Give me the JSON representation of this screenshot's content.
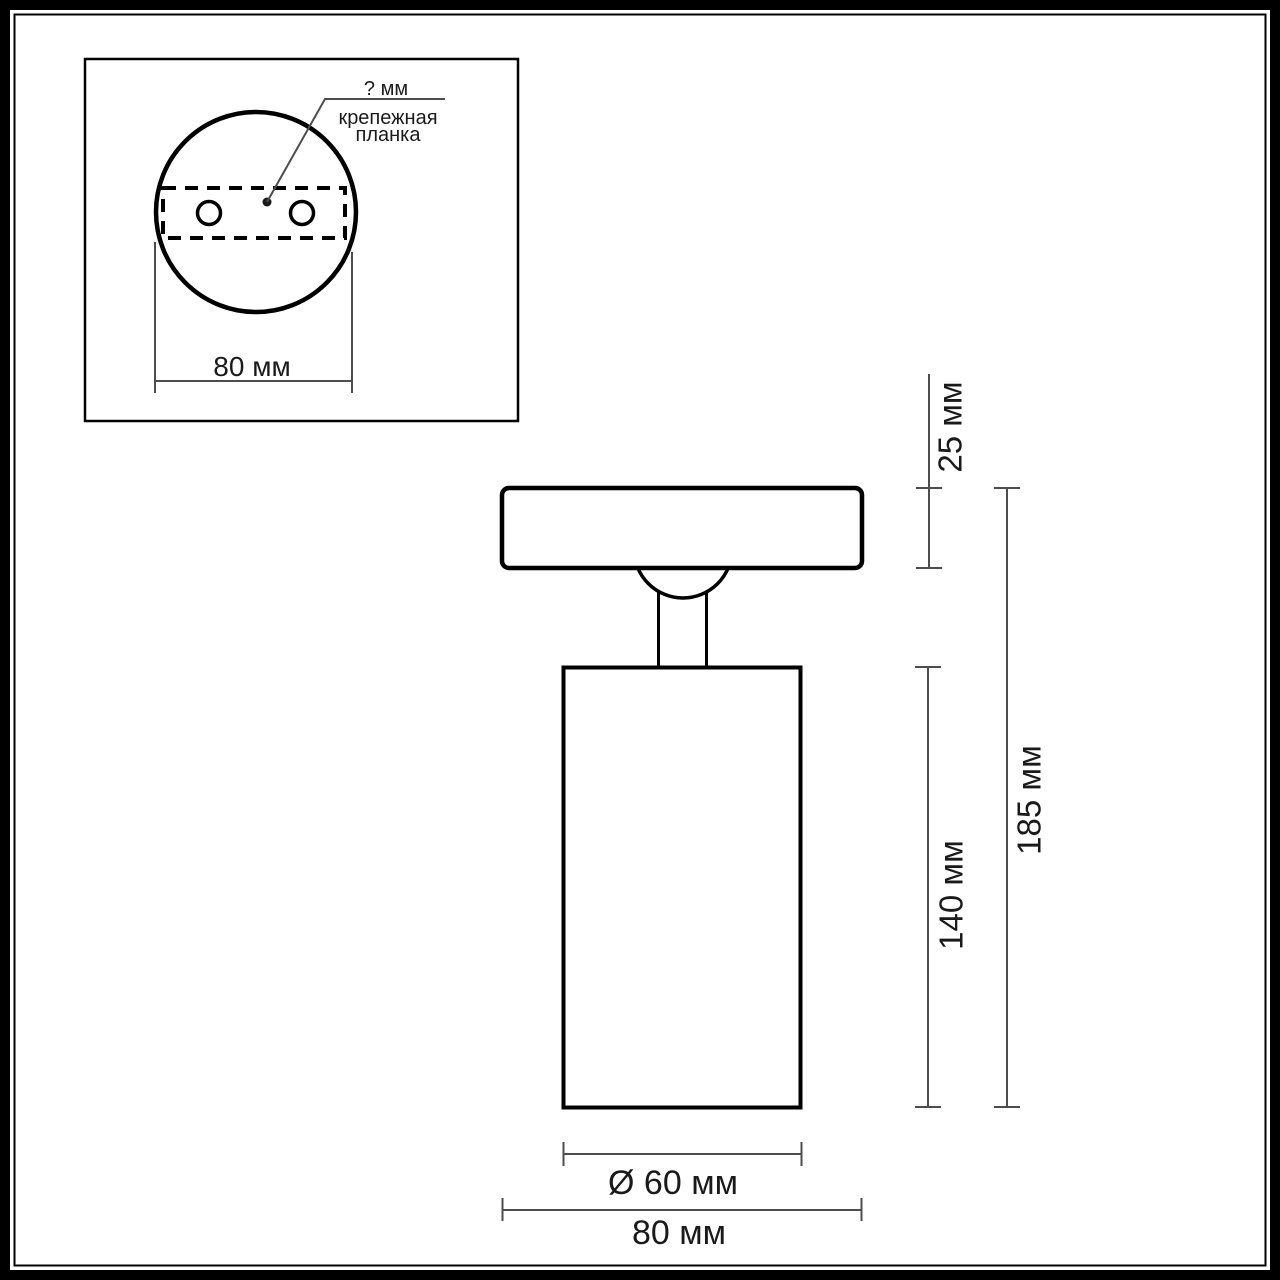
{
  "colors": {
    "drawing_line": "#000000",
    "dimension_line": "#4d4d4d",
    "text": "#1a1a1a",
    "background": "#ffffff"
  },
  "inset": {
    "callout_value": "? мм",
    "callout_label_line1": "крепежная",
    "callout_label_line2": "планка",
    "base_width": "80 мм"
  },
  "dimensions": {
    "base_height": "25 мм",
    "total_height": "185 мм",
    "body_height": "140 мм",
    "body_diameter": "Ø 60 мм",
    "base_width": "80 мм"
  }
}
